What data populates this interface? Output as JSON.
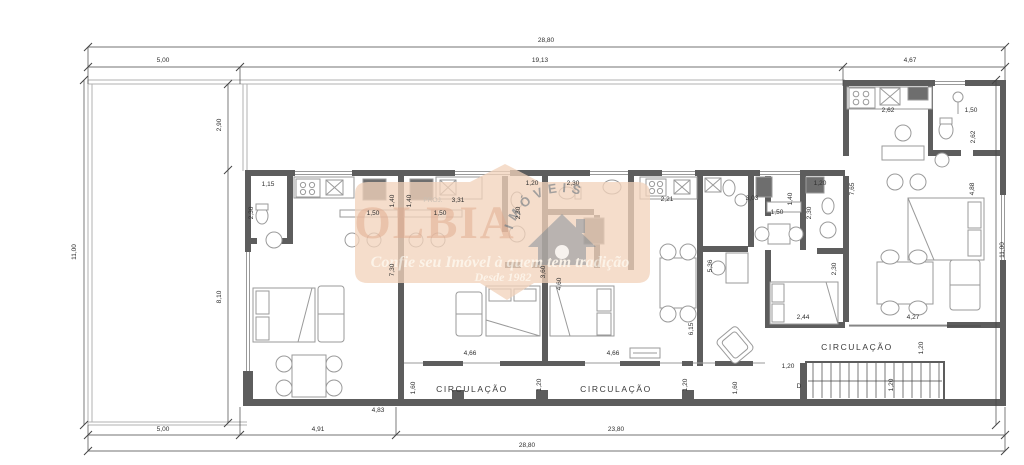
{
  "watermark": {
    "brand": "OLBIA",
    "arc_text": "IMÓVEIS",
    "tagline": "Confie seu Imóvel à quem tem tradição",
    "since": "Desde 1982"
  },
  "colors": {
    "wall": "#5d5d5d",
    "furniture_line": "#9a9a9a",
    "dimension_line": "#444444",
    "watermark_bg": "#f2d2bb",
    "watermark_text": "#e6b79c"
  },
  "annotations": [
    {
      "t": "28,80",
      "x": 546,
      "y": 42
    },
    {
      "t": "5,00",
      "x": 163,
      "y": 62
    },
    {
      "t": "19,13",
      "x": 540,
      "y": 62
    },
    {
      "t": "4,67",
      "x": 910,
      "y": 62
    },
    {
      "t": "11,00",
      "x": 76,
      "y": 252,
      "r": -90
    },
    {
      "t": "2,90",
      "x": 221,
      "y": 125,
      "r": -90
    },
    {
      "t": "8,10",
      "x": 221,
      "y": 297,
      "r": -90
    },
    {
      "t": "11,00",
      "x": 1004,
      "y": 250,
      "r": -90
    },
    {
      "t": "5,00",
      "x": 163,
      "y": 431
    },
    {
      "t": "4,91",
      "x": 318,
      "y": 431
    },
    {
      "t": "23,80",
      "x": 616,
      "y": 431
    },
    {
      "t": "28,80",
      "x": 527,
      "y": 447
    },
    {
      "t": "1,15",
      "x": 268,
      "y": 186
    },
    {
      "t": "2,30",
      "x": 253,
      "y": 213,
      "r": -90
    },
    {
      "t": "1,40",
      "x": 394,
      "y": 201,
      "r": -90,
      "s": 5
    },
    {
      "t": "1,40",
      "x": 411,
      "y": 201,
      "r": -90,
      "s": 5
    },
    {
      "t": "PROJ.",
      "x": 433,
      "y": 202,
      "s": 5,
      "c": "gray"
    },
    {
      "t": "3,31",
      "x": 458,
      "y": 202
    },
    {
      "t": "1,50",
      "x": 373,
      "y": 215
    },
    {
      "t": "1,50",
      "x": 440,
      "y": 215
    },
    {
      "t": "7,30",
      "x": 394,
      "y": 270,
      "r": -90
    },
    {
      "t": "1,20",
      "x": 532,
      "y": 185
    },
    {
      "t": "2,30",
      "x": 573,
      "y": 185
    },
    {
      "t": "2,30",
      "x": 520,
      "y": 213,
      "r": -90
    },
    {
      "t": "3,60",
      "x": 545,
      "y": 272,
      "r": -90
    },
    {
      "t": "4,60",
      "x": 561,
      "y": 284,
      "r": -90
    },
    {
      "t": "2,21",
      "x": 667,
      "y": 201
    },
    {
      "t": "3,03",
      "x": 752,
      "y": 200
    },
    {
      "t": "1,40",
      "x": 792,
      "y": 199,
      "r": -90
    },
    {
      "t": "1,50",
      "x": 777,
      "y": 214
    },
    {
      "t": "1,20",
      "x": 820,
      "y": 185
    },
    {
      "t": "2,30",
      "x": 811,
      "y": 213,
      "r": -90
    },
    {
      "t": "5,36",
      "x": 712,
      "y": 266,
      "r": -90
    },
    {
      "t": "6,15",
      "x": 693,
      "y": 329,
      "r": -90
    },
    {
      "t": "2,30",
      "x": 836,
      "y": 269,
      "r": -90
    },
    {
      "t": "2,44",
      "x": 803,
      "y": 319
    },
    {
      "t": "4,27",
      "x": 913,
      "y": 319
    },
    {
      "t": "1,20",
      "x": 923,
      "y": 348,
      "r": -90
    },
    {
      "t": "CIRCULAÇÃO",
      "x": 857,
      "y": 350,
      "c": "room"
    },
    {
      "t": "1,20",
      "x": 788,
      "y": 368
    },
    {
      "t": "D",
      "x": 799,
      "y": 388,
      "s": 9
    },
    {
      "t": "1,20",
      "x": 893,
      "y": 385,
      "r": -90
    },
    {
      "t": "2,62",
      "x": 888,
      "y": 112
    },
    {
      "t": "1,50",
      "x": 971,
      "y": 112
    },
    {
      "t": "2,62",
      "x": 975,
      "y": 137,
      "r": -90
    },
    {
      "t": "7,65",
      "x": 854,
      "y": 189,
      "r": -90
    },
    {
      "t": "4,88",
      "x": 974,
      "y": 189,
      "r": -90
    },
    {
      "t": "4,66",
      "x": 470,
      "y": 355
    },
    {
      "t": "4,66",
      "x": 613,
      "y": 355
    },
    {
      "t": "1,60",
      "x": 415,
      "y": 388,
      "r": -90
    },
    {
      "t": "CIRCULAÇÃO",
      "x": 472,
      "y": 392,
      "c": "room"
    },
    {
      "t": "1,20",
      "x": 541,
      "y": 385,
      "r": -90
    },
    {
      "t": "CIRCULAÇÃO",
      "x": 616,
      "y": 392,
      "c": "room"
    },
    {
      "t": "1,20",
      "x": 687,
      "y": 385,
      "r": -90
    },
    {
      "t": "1,60",
      "x": 737,
      "y": 388,
      "r": -90
    },
    {
      "t": "4,83",
      "x": 378,
      "y": 412
    }
  ]
}
